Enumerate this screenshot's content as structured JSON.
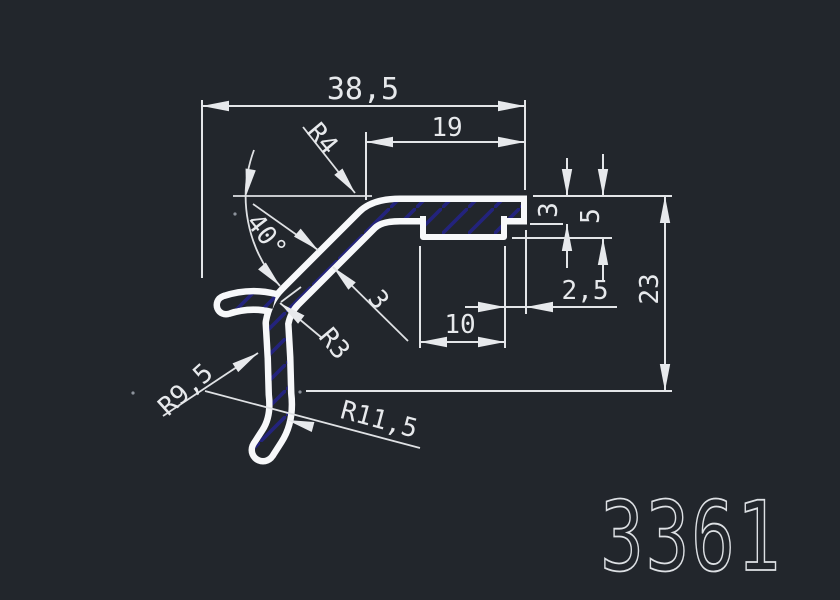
{
  "drawing_number": "3361",
  "canvas": {
    "background_color": "#22262c",
    "line_color": "#e3e5e8",
    "profile_color": "#f7f8fa",
    "hatch_color": "#23237d"
  },
  "dimensions": {
    "total_width": "38,5",
    "top_width": "19",
    "arm_thickness": "3",
    "rib_depth": "5",
    "rib_offset": "2,5",
    "total_height": "23",
    "rib_width": "10",
    "angle": "40°",
    "wall_thickness": "3",
    "radius_top": "R4",
    "radius_inner": "R3",
    "radius_leg": "R9,5",
    "radius_hook": "R11,5"
  }
}
